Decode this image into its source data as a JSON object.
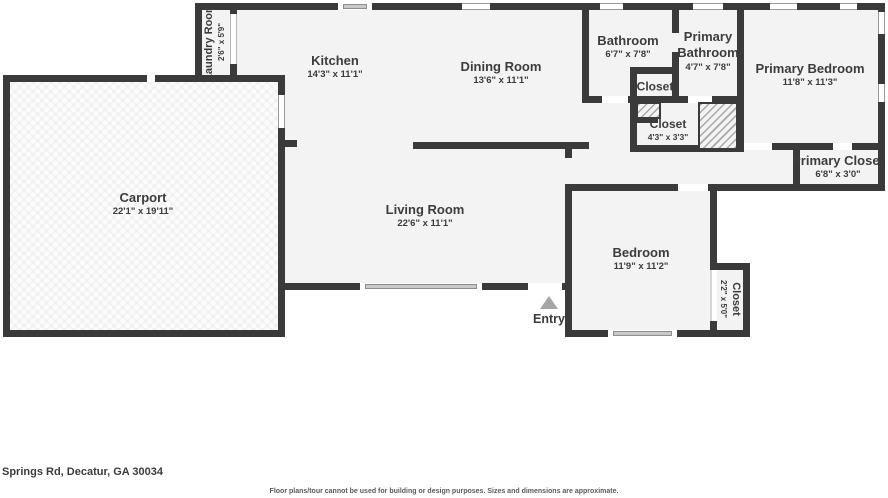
{
  "floorplan": {
    "address": "Springs Rd, Decatur, GA 30034",
    "disclaimer": "Floor plans/tour cannot be used for building or design purposes. Sizes and dimensions are approximate.",
    "rooms": {
      "laundry": {
        "name": "Laundry Room",
        "dims": "2'6\" x 5'9\""
      },
      "kitchen": {
        "name": "Kitchen",
        "dims": "14'3\" x 11'1\""
      },
      "dining": {
        "name": "Dining Room",
        "dims": "13'6\" x 11'1\""
      },
      "bathroom": {
        "name": "Bathroom",
        "dims": "6'7\" x 7'8\""
      },
      "primary_bathroom": {
        "name": "Primary Bathroom",
        "dims": "4'7\" x 7'8\""
      },
      "primary_bedroom": {
        "name": "Primary Bedroom",
        "dims": "11'8\" x 11'3\""
      },
      "hall_closet": {
        "name": "Closet"
      },
      "closet2": {
        "name": "Closet",
        "dims": "4'3\" x 3'3\""
      },
      "primary_closet": {
        "name": "Primary Closet",
        "dims": "6'8\" x 3'0\""
      },
      "carport": {
        "name": "Carport",
        "dims": "22'1\" x 19'11\""
      },
      "living": {
        "name": "Living Room",
        "dims": "22'6\" x 11'1\""
      },
      "bedroom": {
        "name": "Bedroom",
        "dims": "11'9\" x 11'2\""
      },
      "bedroom_closet": {
        "name": "Closet",
        "dims": "2'2\" x 5'0\""
      },
      "entry": {
        "label": "Entry"
      }
    },
    "colors": {
      "wall": "#3a3a3a",
      "floor": "#f3f3f3",
      "label": "#3c3c40",
      "window_bar": "#c9c9c9"
    }
  }
}
